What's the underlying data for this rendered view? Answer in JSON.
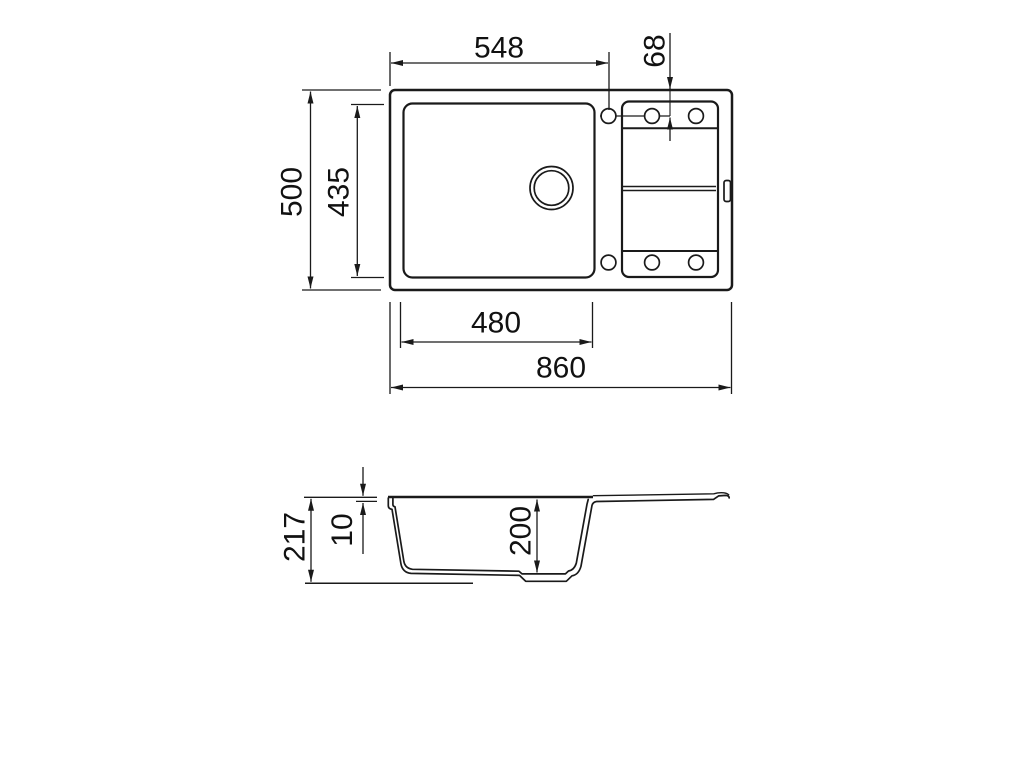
{
  "diagram": {
    "type": "technical-drawing",
    "subject": "kitchen sink with bowl and drainer tray, dimensioned",
    "colors": {
      "background": "#ffffff",
      "lines": "#1a1a1a"
    },
    "views": [
      {
        "name": "top-view",
        "features": [
          "outer-edge",
          "main-bowl",
          "drain-hole",
          "drainer-tray",
          "tap-holes-top-row",
          "tap-holes-bottom-row",
          "overflow-slot"
        ],
        "dimension_labels": [
          "548",
          "68",
          "500",
          "435",
          "480",
          "860"
        ]
      },
      {
        "name": "side-section-view",
        "features": [
          "rim",
          "bowl-profile",
          "drain-boss",
          "drainboard",
          "ground-line"
        ],
        "dimension_labels": [
          "217",
          "10",
          "200"
        ]
      }
    ]
  },
  "dimensions": {
    "bowl_outer_width": "548",
    "tap_hole_offset": "68",
    "overall_depth": "500",
    "bowl_inner_length": "435",
    "bowl_width": "480",
    "overall_width": "860",
    "overall_height": "217",
    "rim_thickness": "10",
    "bowl_depth": "200"
  }
}
